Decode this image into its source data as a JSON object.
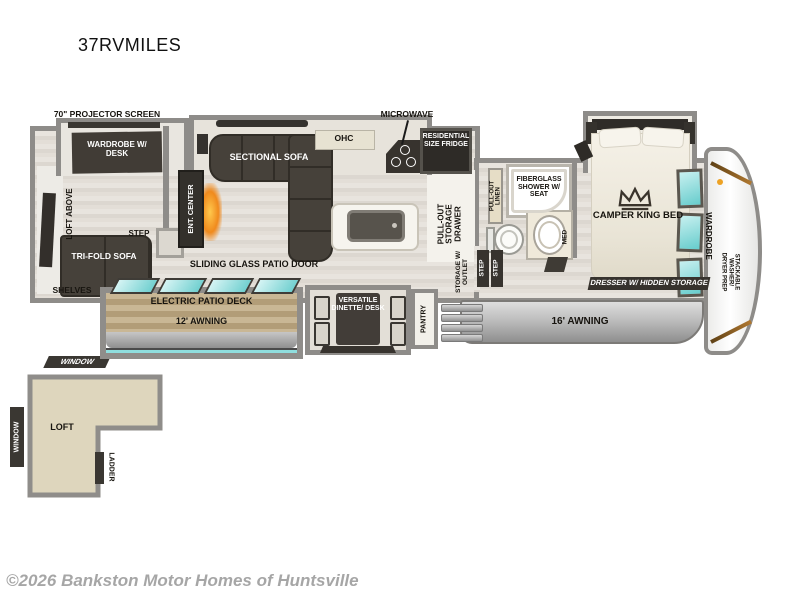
{
  "labels": {
    "title": "37RVMILES",
    "projector": "70\" PROJECTOR SCREEN",
    "wardrobe_desk": "WARDROBE W/ DESK",
    "loft_above": "LOFT ABOVE",
    "step_rear": "STEP",
    "tri_fold": "TRI-FOLD SOFA",
    "shelves": "SHELVES",
    "ent_center": "ENT. CENTER",
    "sectional": "SECTIONAL SOFA",
    "ohc": "OHC",
    "microwave": "MICROWAVE",
    "fridge": "RESIDENTIAL SIZE FRIDGE",
    "sliding_door": "SLIDING GLASS PATIO DOOR",
    "deck": "ELECTRIC PATIO DECK",
    "awning12": "12' AWNING",
    "dinette": "VERSATILE DINETTE/ DESK",
    "pantry": "PANTRY",
    "pullout_drawer": "PULL-OUT STORAGE DRAWER",
    "storage_outlet": "STORAGE W/ OUTLET",
    "step": "STEP",
    "linen": "PULL-OUT LINEN",
    "shower": "FIBERGLASS SHOWER W/ SEAT",
    "med": "MED",
    "king_bed": "CAMPER KING BED",
    "dresser": "DRESSER W/ HIDDEN STORAGE",
    "wardrobe": "WARDROBE",
    "washer_prep": "STACKABLE WASHER/ DRYER PREP",
    "awning16": "16' AWNING",
    "window": "WINDOW",
    "loft": "LOFT",
    "ladder": "LADDER",
    "copyright": "©2026 Bankston Motor Homes of Huntsville"
  },
  "colors": {
    "wall_gray": "#8e8c89",
    "furniture_dark": "#46413a",
    "glass_teal": "#6fcfcf",
    "deck_tan": "#c1ae88",
    "fireplace_orange": "#f08a1d",
    "accent_orange": "#eda224",
    "loft_fill": "#ded6bd",
    "copyright_gray": "#a6a6a6"
  },
  "icons": {
    "bed_logo": "crown-icon",
    "fireplace": "fireplace-icon"
  }
}
